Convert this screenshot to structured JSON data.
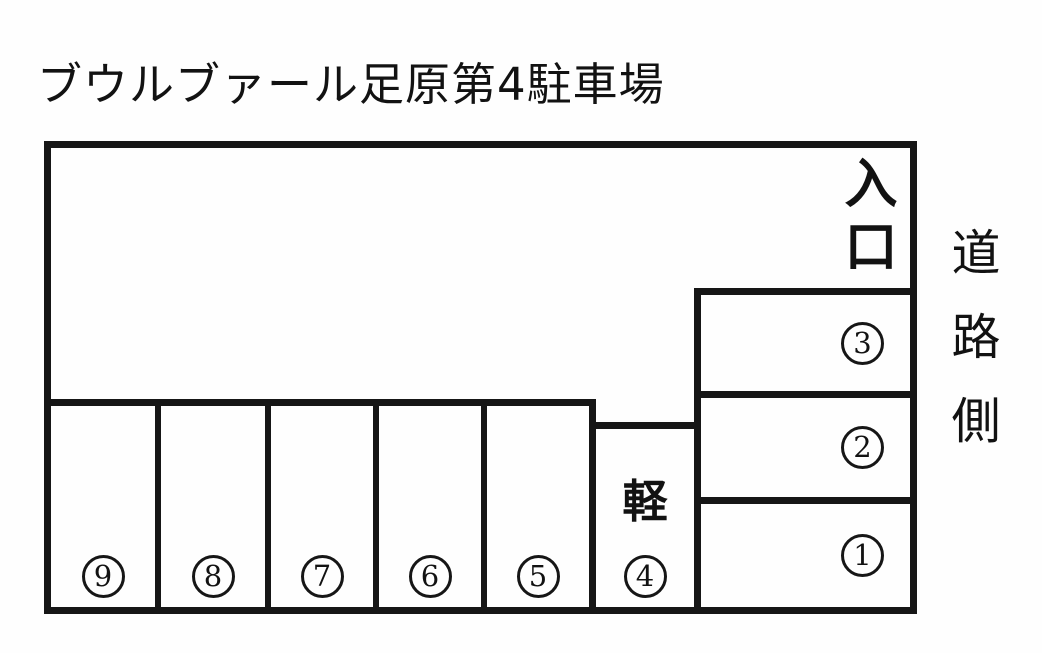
{
  "title": "ブウルブァール足原第4駐車場",
  "labels": {
    "entrance": "入口",
    "road_side": "道路側",
    "kei": "軽"
  },
  "spaces": [
    {
      "digit": "1",
      "glyph": "①"
    },
    {
      "digit": "2",
      "glyph": "②"
    },
    {
      "digit": "3",
      "glyph": "③"
    },
    {
      "digit": "4",
      "glyph": "④"
    },
    {
      "digit": "5",
      "glyph": "⑤"
    },
    {
      "digit": "6",
      "glyph": "⑥"
    },
    {
      "digit": "7",
      "glyph": "⑦"
    },
    {
      "digit": "8",
      "glyph": "⑧"
    },
    {
      "digit": "9",
      "glyph": "⑨"
    }
  ]
}
